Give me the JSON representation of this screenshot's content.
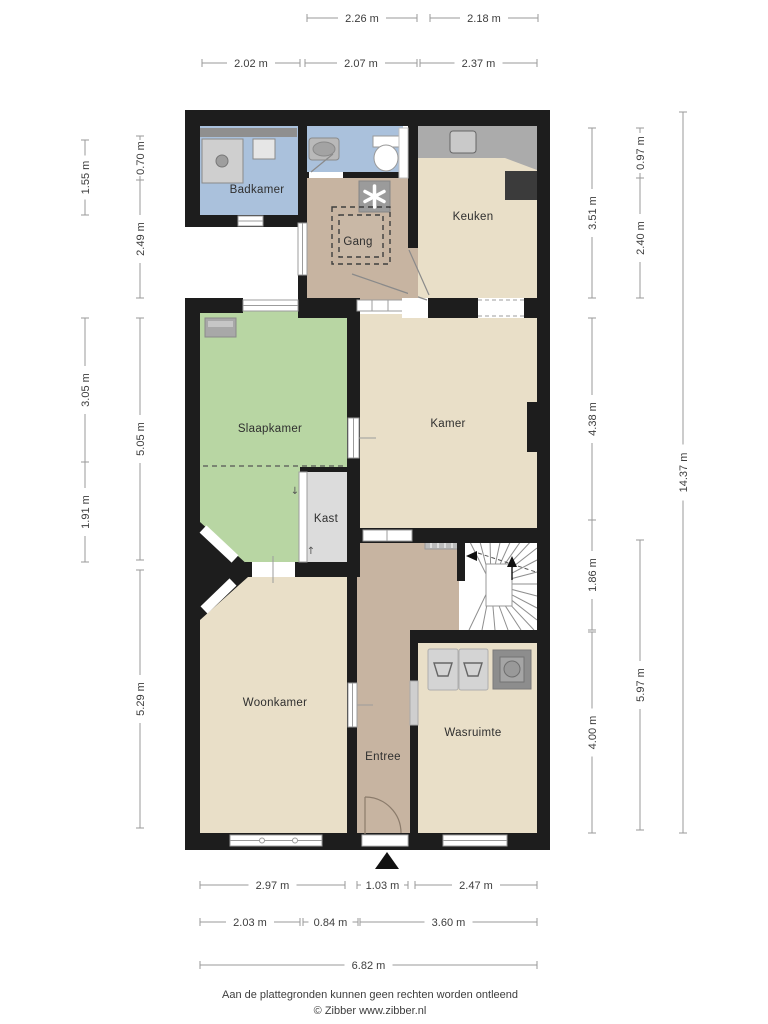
{
  "rooms": {
    "badkamer": {
      "label": "Badkamer"
    },
    "gang": {
      "label": "Gang"
    },
    "keuken": {
      "label": "Keuken"
    },
    "slaapkamer": {
      "label": "Slaapkamer"
    },
    "kamer": {
      "label": "Kamer"
    },
    "kast": {
      "label": "Kast"
    },
    "woonkamer": {
      "label": "Woonkamer"
    },
    "entree": {
      "label": "Entree"
    },
    "wasruimte": {
      "label": "Wasruimte"
    }
  },
  "dimensions": {
    "top": [
      {
        "label": "2.26 m"
      },
      {
        "label": "2.18 m"
      },
      {
        "label": "2.02 m"
      },
      {
        "label": "2.07 m"
      },
      {
        "label": "2.37 m"
      }
    ],
    "left": [
      {
        "label": "1.55 m"
      },
      {
        "label": "3.05 m"
      },
      {
        "label": "1.91 m"
      },
      {
        "label": "0.70 m"
      },
      {
        "label": "2.49 m"
      },
      {
        "label": "5.05 m"
      },
      {
        "label": "5.29 m"
      }
    ],
    "right": [
      {
        "label": "3.51 m"
      },
      {
        "label": "4.38 m"
      },
      {
        "label": "1.86 m"
      },
      {
        "label": "4.00 m"
      },
      {
        "label": "0.97 m"
      },
      {
        "label": "2.40 m"
      },
      {
        "label": "5.97 m"
      },
      {
        "label": "14.37 m"
      }
    ],
    "bottom": [
      {
        "label": "2.97 m"
      },
      {
        "label": "1.03 m"
      },
      {
        "label": "2.47 m"
      },
      {
        "label": "2.03 m"
      },
      {
        "label": "0.84 m"
      },
      {
        "label": "3.60 m"
      },
      {
        "label": "6.82 m"
      }
    ]
  },
  "footer": {
    "line1": "Aan de plattegronden kunnen geen rechten worden ontleend",
    "line2": "© Zibber www.zibber.nl"
  },
  "colors": {
    "wall": "#1d1d1d",
    "bathroom_floor": "#aac1dc",
    "hallway_floor": "#c7b4a1",
    "room_floor": "#e9dfc8",
    "bedroom_floor": "#b8d6a3",
    "closet_floor": "#dcdcdc",
    "counter": "#ababab",
    "appliance_dark": "#3b3b3b",
    "fixture_gray": "#cfcfcf"
  },
  "icons": {
    "arrow_down_glyph": "↓",
    "arrow_up_glyph": "↑"
  }
}
